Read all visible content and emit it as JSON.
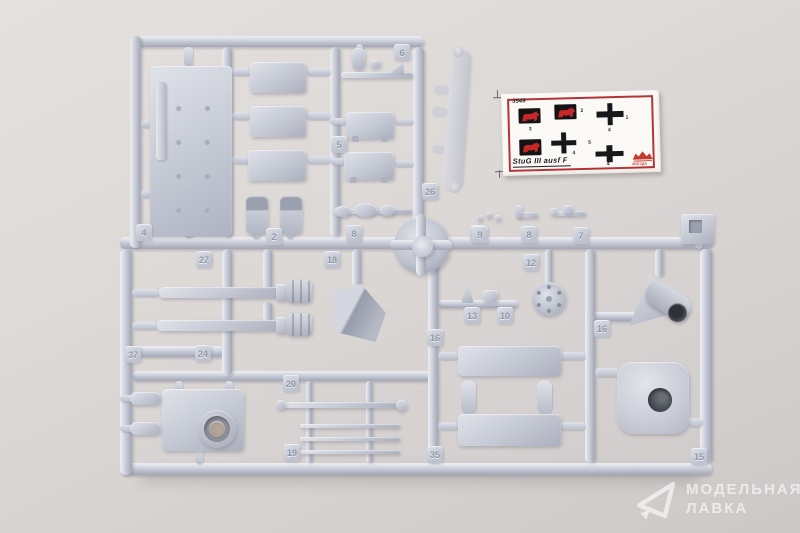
{
  "photo": {
    "background_color": "#ddd9d7"
  },
  "sprue": {
    "plastic_color": "#c4c8d3",
    "part_tags": [
      {
        "n": "4"
      },
      {
        "n": "2"
      },
      {
        "n": "6"
      },
      {
        "n": "5"
      },
      {
        "n": "26"
      },
      {
        "n": "8"
      },
      {
        "n": "4"
      },
      {
        "n": "27"
      },
      {
        "n": "18"
      },
      {
        "n": "37"
      },
      {
        "n": "24"
      },
      {
        "n": "20"
      },
      {
        "n": "19"
      },
      {
        "n": "9"
      },
      {
        "n": "8"
      },
      {
        "n": "7"
      },
      {
        "n": "12"
      },
      {
        "n": "13"
      },
      {
        "n": "10"
      },
      {
        "n": "16"
      },
      {
        "n": "35"
      },
      {
        "n": "15"
      },
      {
        "n": "16"
      }
    ]
  },
  "decal": {
    "catalog_number": "3549",
    "title": "StuG III ausf F",
    "brand": "ЗВЕЗДА",
    "border_color": "#b5323a",
    "labels": {
      "cross1": "1",
      "elephant_top": "2",
      "elephant_left": "3",
      "cross1_size": "4",
      "cross2_size": "4",
      "cross3_size": "4",
      "center": "5"
    }
  },
  "watermark": {
    "line1": "МОДЕЛЬНАЯ",
    "line2": "ЛАВКА"
  }
}
